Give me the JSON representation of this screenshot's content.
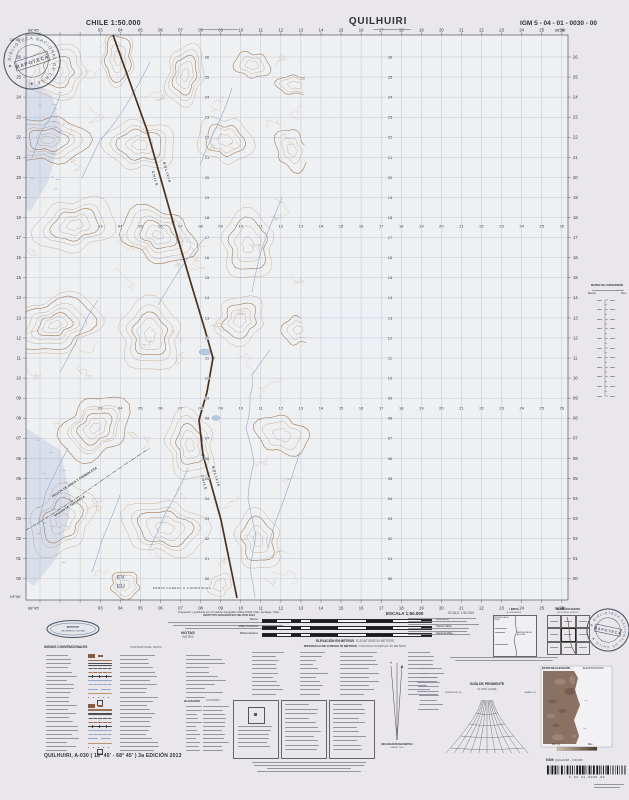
{
  "header": {
    "country_scale": "CHILE 1:50.000",
    "title": "QUILHUIRI",
    "sheet_code": "IGM 5 - 04 - 01 - 0030 - 00"
  },
  "stamp": {
    "center": "MAPOTECA",
    "ring": "★ BIBLIOTECA NACIONAL DE CHILE ★"
  },
  "map": {
    "boundary_country_west": "CHILE",
    "boundary_country_east": "BOLIVIA",
    "region_label_1": "REGIÓN DE ARICA Y PARINACOTA",
    "region_label_2": "REGIÓN DE TARAPACÁ",
    "pampa_label": "PAMPA CANEZA O CHORONCHA",
    "pencil_note_1": "EV",
    "pencil_note_2": "EU",
    "corner_top_left_lon": "68°45'",
    "corner_top_right_lon": "68°30'",
    "corner_left_top_lat": "18°45'",
    "corner_left_bottom_lat": "19°00'",
    "easting_labels": [
      "03",
      "04",
      "05",
      "06",
      "07",
      "08",
      "09",
      "10",
      "11",
      "12",
      "13",
      "14",
      "15",
      "16",
      "17",
      "18",
      "19",
      "20",
      "21",
      "22",
      "23",
      "24",
      "25",
      "26"
    ],
    "northing_labels": [
      "26",
      "25",
      "24",
      "23",
      "22",
      "21",
      "20",
      "19",
      "18",
      "17",
      "16",
      "15",
      "14",
      "13",
      "12",
      "11",
      "10",
      "09",
      "08",
      "07",
      "06",
      "05",
      "04",
      "03",
      "02",
      "01",
      "00"
    ],
    "grid_color": "#a9b2c6",
    "contour_color": "#b18a63",
    "water_color": "#89a4c9",
    "boundary_color": "#4a3222"
  },
  "margin_right": {
    "matrix_title": "MATRIZ DE CONVERSIÓN",
    "matrix_col_left": "Metros",
    "matrix_col_right": "Pies"
  },
  "footer": {
    "credit_line_1": "Preparado y publicado por el Instituto Geográfico Militar (IGM) Chile, Santiago, Chile.",
    "credit_line_2": "INSTITUTO GEOGRÁFICO MILITAR 2013",
    "notas": "NOTAS",
    "notes": "NOTES",
    "escala": "ESCALA 1:50.000",
    "scale_en": "SCALE 1:50.000",
    "bars": [
      {
        "left": "Metros",
        "right": "Kilómetros"
      },
      {
        "left": "Millas Terrestres",
        "right": "Statute Miles"
      },
      {
        "left": "Millas Náuticas",
        "right": "Nautical Miles"
      }
    ],
    "elev_es": "ELEVACIÓN EN METROS",
    "elev_en": "ELEVATIONS IN METERS",
    "interval_es": "INTERVALO DE CURVAS 50 METROS",
    "interval_en": "CONTOUR INTERVAL 50 METERS",
    "signos": "SIGNOS CONVENCIONALES",
    "signs_en": "CONVENTIONAL SIGNS",
    "glosario": "GLOSARIO",
    "glossary": "GLOSSARY",
    "limites": "LÍMITES",
    "boundaries_en": "BOUNDARIES",
    "republica_chile": "REPÚBLICA DE CHILE",
    "republica_bolivia": "REPÚBLICA DE BOLIVIA",
    "hojas": "HOJAS ADYACENTES",
    "adjoining": "ADJOINING SHEETS",
    "decl_1": "DECLINACIÓN MAGNÉTICA",
    "decl_2": "ENERO 2013",
    "pendiente": "GUÍA DE PENDIENTE",
    "slope": "SLOPE GUIDE",
    "pendiente_pct": "PENDIENTE (%)",
    "grade_pct": "GRADE (%)",
    "datos_elev": "DATOS DE ELEVACIÓN",
    "elev_data": "ELEVATION DATA",
    "min_label": "Mín (m)",
    "max_label": "Máx",
    "igm_abbr": "IGM",
    "igm_product": "QUILHUIRI - 1:50.000",
    "igm_logo_line1": "INSTITUTO",
    "igm_logo_line2": "GEOGRÁFICO MILITAR",
    "barcode_digits": "5  04  01  0030  00",
    "edition_line": "QUILHUIRI, A-030 ( 18° 45' - 68° 45' ) 3a EDICIÓN 2013"
  }
}
